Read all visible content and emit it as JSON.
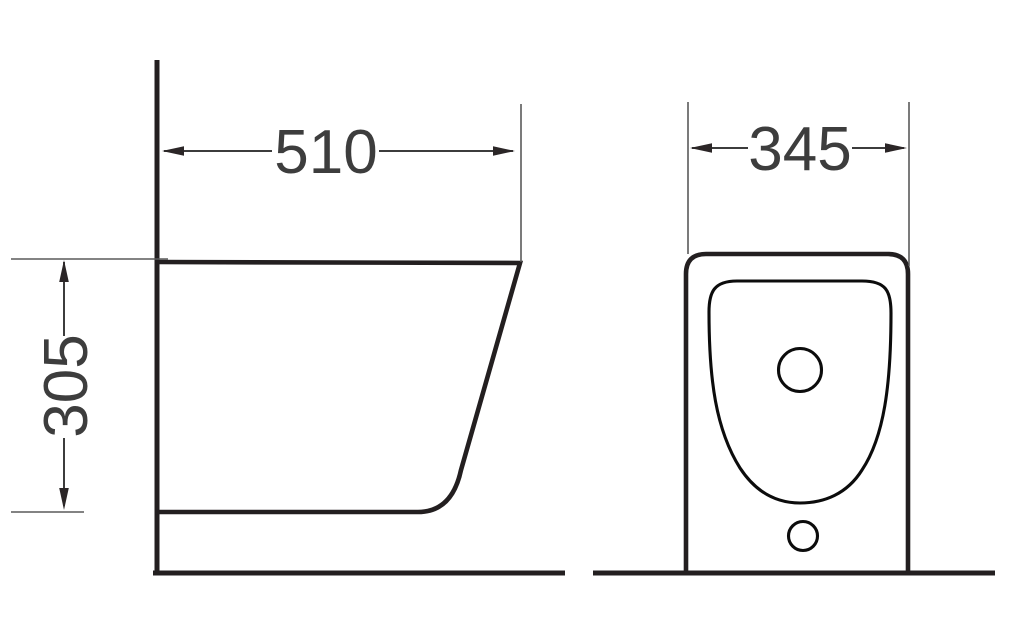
{
  "diagram": {
    "background_color": "#ffffff",
    "outline_color": "#231f20",
    "dimension_text_color": "#3d3d3d",
    "views": [
      {
        "name": "side view",
        "dimensions": [
          {
            "label": "510",
            "orientation": "horizontal",
            "position": "top"
          },
          {
            "label": "305",
            "orientation": "vertical",
            "position": "left"
          }
        ]
      },
      {
        "name": "front view",
        "dimensions": [
          {
            "label": "345",
            "orientation": "horizontal",
            "position": "top"
          }
        ]
      }
    ]
  }
}
